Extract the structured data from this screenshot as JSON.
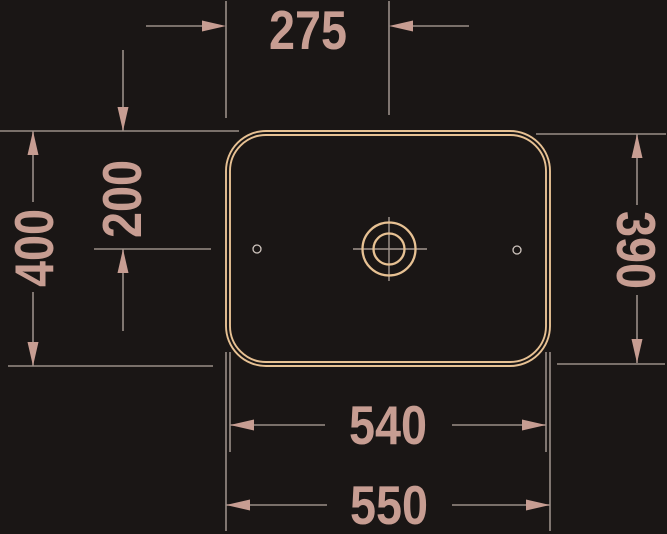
{
  "meta": {
    "description": "Technical top-view dimension drawing of a rectangular countertop washbasin with centered drain"
  },
  "colors": {
    "background": "#1a1615",
    "outline": "#e7c193",
    "line": "#998e87",
    "accent": "#c79d92",
    "centerline": "#a3968e",
    "detail": "#cfc5be"
  },
  "dimensions": {
    "center_from_left": "275",
    "overall_depth": "400",
    "center_from_top": "200",
    "inner_depth": "390",
    "inner_width": "540",
    "overall_width": "550"
  }
}
